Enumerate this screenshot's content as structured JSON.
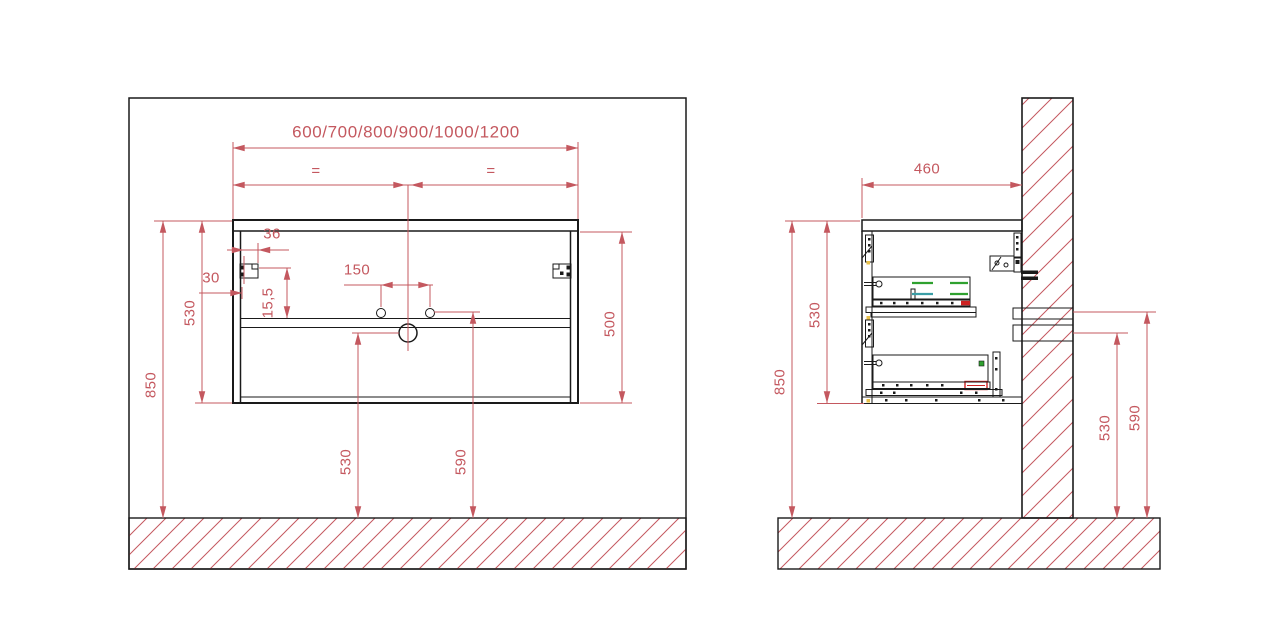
{
  "drawing": {
    "type": "wall-hung vanity cabinet installation drawing",
    "views": [
      "front elevation",
      "side section"
    ],
    "colors": {
      "dimension_red": "#c4585f",
      "line_black": "#1a1a1a",
      "slide_green": "#2fa12f",
      "slide_teal": "#3a9ea6",
      "dowel_yellow": "#e8c04a",
      "accent_red": "#cc2222"
    }
  },
  "front_view": {
    "width_options": "600/700/800/900/1000/1200",
    "equal_segment_left": "=",
    "equal_segment_right": "=",
    "dim_bracket_inset": "36",
    "dim_bracket_side_offset": "30",
    "dim_bracket_drop": "15,5",
    "dim_faucet_hole_spacing": "150",
    "dim_cabinet_height": "530",
    "dim_mounting_height": "850",
    "dim_inner_height": "500",
    "dim_drain_height": "530",
    "dim_outlet_height": "590"
  },
  "side_view": {
    "dim_depth": "460",
    "dim_mounting_height": "850",
    "dim_cabinet_height": "530",
    "dim_supply_height": "530",
    "dim_drain_height": "590"
  }
}
